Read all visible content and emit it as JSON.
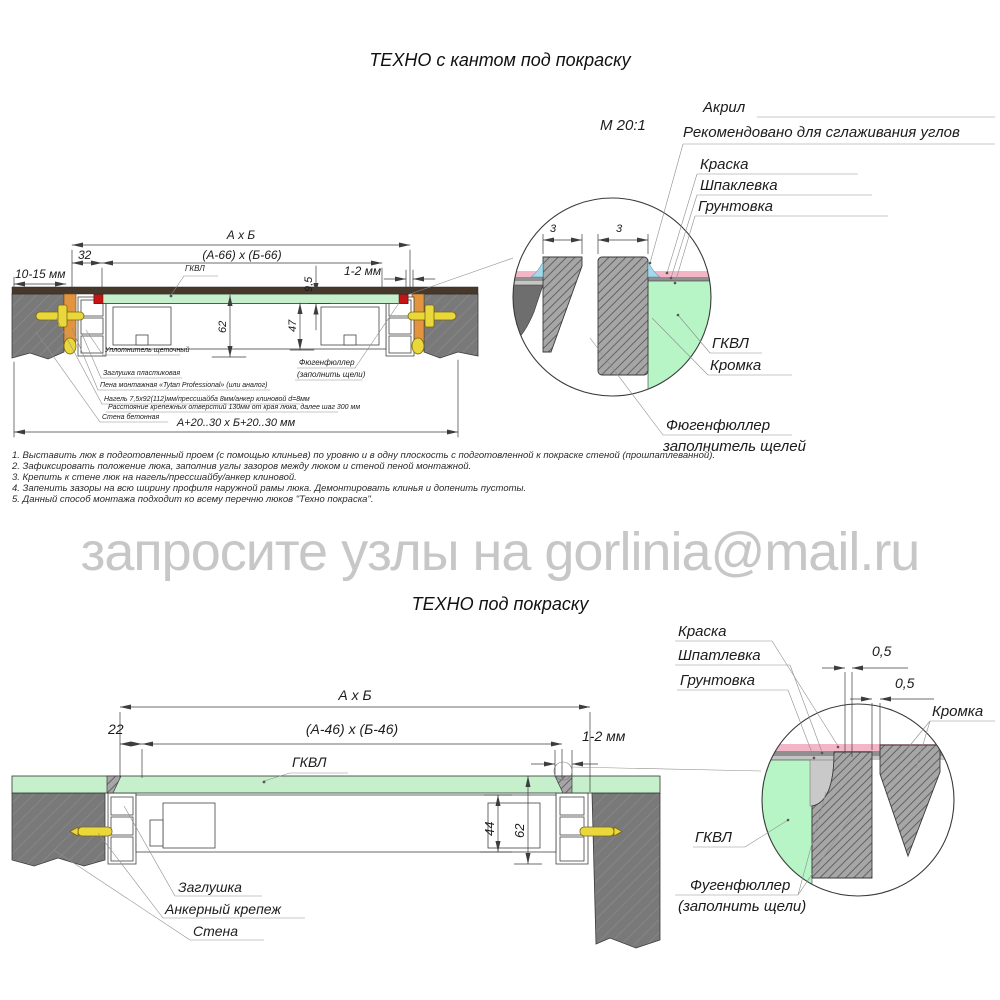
{
  "watermark": "запросите узлы на gorlinia@mail.ru",
  "colors": {
    "gkvl_green": "#c6f0cb",
    "detail_green": "#b7f4c6",
    "wall_gray": "#7b7b7b",
    "painted_layer_dark": "#46392c",
    "wood_orange": "#e2943f",
    "anchor_yellow": "#ead73b",
    "kant_red": "#c41414",
    "paint_pink": "#f2b6c6",
    "acryl_blue": "#a5d8ea",
    "watermark_gray": "#c7c7c7"
  },
  "top": {
    "title": "ТЕХНО с кантом под покраску",
    "scale_label": "М 20:1",
    "layer_labels": {
      "acryl": "Акрил",
      "acryl_note": "Рекомендовано для сглаживания углов",
      "paint": "Краска",
      "putty": "Шпаклевка",
      "primer": "Грунтовка"
    },
    "detail_labels": {
      "gkvl": "ГКВЛ",
      "kromka": "Кромка",
      "fugen_line1": "Фюгенфюллер",
      "fugen_line2": "заполнитель щелей",
      "dim3_left": "3",
      "dim3_right": "3"
    },
    "dims": {
      "outer": "А х Б",
      "inner": "(А-66) х (Б-66)",
      "offset32": "32",
      "wall_gap": "10-15 мм",
      "gkvl": "ГКВЛ",
      "thickness": "9,5",
      "gap": "1-2 мм",
      "height_outer": "62",
      "height_inner": "47",
      "opening": "А+20..30 х Б+20..30 мм"
    },
    "callouts": {
      "brush_seal": "Уплотнитель щеточный",
      "plug": "Заглушка пластиковая",
      "foam": "Пена монтажная «Tytan Professional» (или аналог)",
      "dowel": "Нагель 7,5х92(112)мм/прессшайба 8мм/анкер клиновой d=8мм",
      "spacing": "Расстояние крепежных отверстий 130мм от края люка, далее шаг 300 мм",
      "wall": "Стена бетонная",
      "fugen_line1": "Фюгенфюллер",
      "fugen_line2": "(заполнить щели)"
    }
  },
  "notes": [
    "1. Выставить люк в подготовленный проем (с помощью клиньев) по уровню и в одну плоскость с подготовленной к покраске стеной (прошпатлеванной).",
    "2. Зафиксировать положение люка, заполнив углы зазоров между люком и стеной пеной монтажной.",
    "3. Крепить к стене люк на нагель/прессшайбу/анкер клиновой.",
    "4. Запенить зазоры на всю ширину профиля наружной рамы люка. Демонтировать клинья и допенить пустоты.",
    "5. Данный способ монтажа подходит ко всему перечню люков \"Техно покраска\"."
  ],
  "bottom": {
    "title": "ТЕХНО под покраску",
    "layer_labels": {
      "paint": "Краска",
      "putty": "Шпатлевка",
      "primer": "Грунтовка"
    },
    "detail_labels": {
      "dim05_top": "0,5",
      "dim05_bottom": "0,5",
      "kromka": "Кромка",
      "gkvl": "ГКВЛ",
      "fugen_line1": "Фугенфюллер",
      "fugen_line2": "(заполнить щели)"
    },
    "dims": {
      "outer": "А х Б",
      "inner": "(А-46) х (Б-46)",
      "offset22": "22",
      "gap": "1-2 мм",
      "gkvl": "ГКВЛ",
      "height_inner": "44",
      "height_outer": "62"
    },
    "callouts": {
      "plug": "Заглушка",
      "anchor": "Анкерный крепеж",
      "wall": "Стена"
    }
  }
}
